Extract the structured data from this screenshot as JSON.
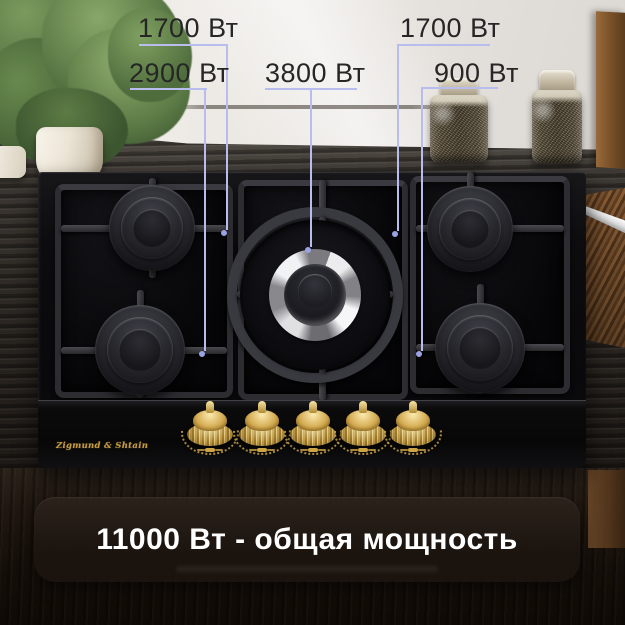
{
  "scene": {
    "type": "gas-hob-product-photo",
    "brand": "Zigmund & Shtain"
  },
  "callouts": {
    "labels": [
      {
        "burner": "top-left",
        "text": "1700 Вт"
      },
      {
        "burner": "bottom-left",
        "text": "2900 Вт"
      },
      {
        "burner": "center-wok",
        "text": "3800 Вт"
      },
      {
        "burner": "top-right",
        "text": "1700 Вт"
      },
      {
        "burner": "bottom-right",
        "text": "900 Вт"
      }
    ],
    "line_color": "#b9bdee",
    "ring_color": "#9ba2e4",
    "text_color": "#262626"
  },
  "banner": {
    "text": "11000 Вт - общая мощность",
    "text_color": "#ffffff",
    "bg_color": "#1d150f"
  },
  "hob": {
    "brand_label": "Zigmund & Shtain",
    "burner_count": 5,
    "knob_count": 5,
    "knob_color": "#d6ae55",
    "glass_color": "#0b0b0d",
    "grate_color": "#333338"
  }
}
